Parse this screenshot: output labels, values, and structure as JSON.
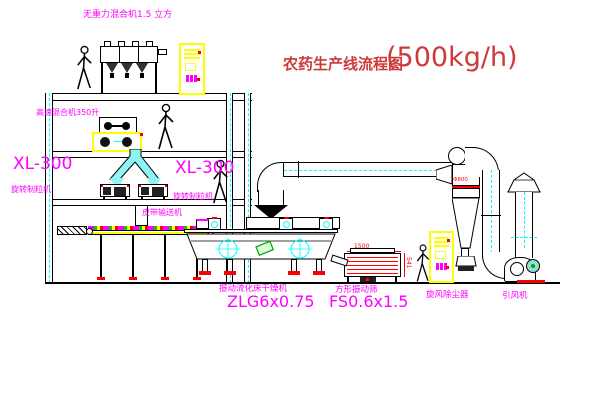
{
  "title": {
    "name_zh": "农药生产线流程图",
    "capacity": "(500kg/h)"
  },
  "equipment_labels": {
    "gravity_mixer": "无重力混合机1.5 立方",
    "high_speed_mixer": "高速混合机350升",
    "granulator_left": {
      "model": "XL-300",
      "name": "旋转制粒机"
    },
    "granulator_right": {
      "model": "XL-300",
      "name": "旋转制粒机"
    },
    "belt_conveyor": "皮带输送机",
    "fluid_bed_dryer": {
      "name": "振动流化床干燥机",
      "model": "ZLG6x0.75"
    },
    "square_sieve": {
      "name": "方形振动筛",
      "model": "FS0.6x1.5"
    },
    "cyclone": "旋风除尘器",
    "induced_draft_fan": "引风机"
  },
  "dimensions": {
    "sieve_length": "1500",
    "sieve_height": "541",
    "cyclone_note": "Φ800"
  },
  "colors": {
    "label_magenta": "#ff00ff",
    "title_red": "#cc3a3a",
    "dimension_red": "#ff0000",
    "centerline_cyan": "#00ffff",
    "cabinet_yellow": "#ffff00",
    "accent_green": "#00a800"
  }
}
